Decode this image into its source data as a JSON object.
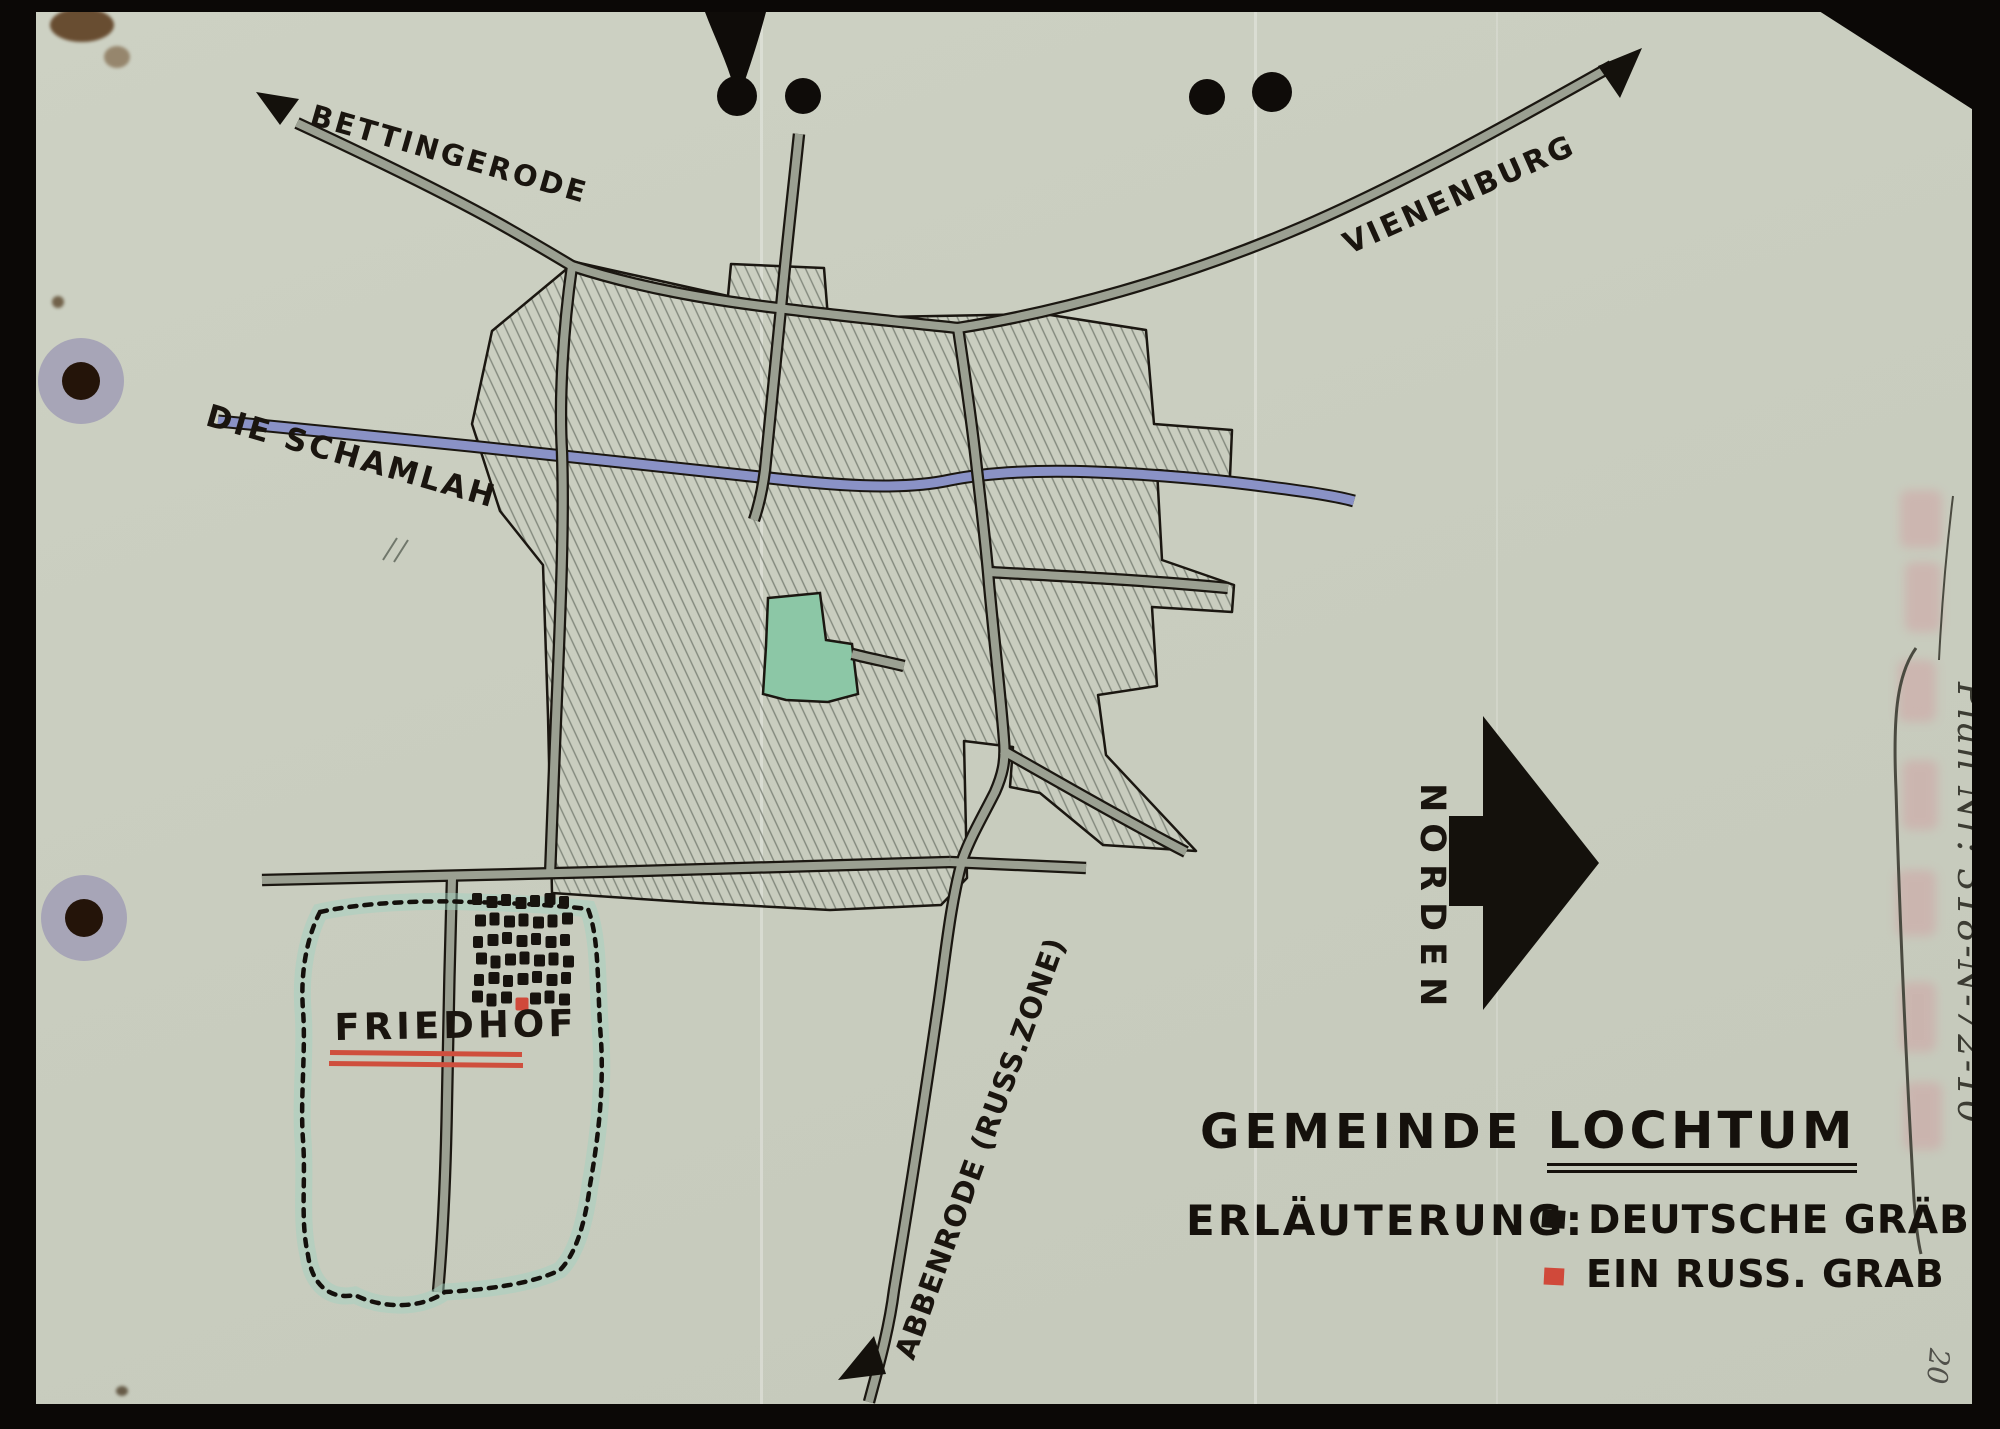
{
  "document": {
    "type": "hand-drawn cemetery location map",
    "paper_color": "#cbcfc1",
    "backdrop_color": "#0b0806"
  },
  "labels": {
    "road_bettingerode": "BETTINGERODE",
    "road_vienenburg": "VIENENBURG",
    "road_abbenrode": "ABBENRODE (RUSS.ZONE)",
    "river": "DIE SCHAMLAH",
    "cemetery": "FRIEDHOF",
    "north": "NORDEN"
  },
  "title": {
    "prefix": "GEMEINDE",
    "name": "LOCHTUM"
  },
  "legend": {
    "heading": "ERLÄUTERUNG:",
    "items": [
      {
        "label": "DEUTSCHE GRÄBER",
        "marker_color": "#17130e"
      },
      {
        "label": "EIN RUSS. GRAB",
        "marker_color": "#d0493a"
      }
    ]
  },
  "marginalia": {
    "plan_number": "Plan Nr: 318-N-72-10",
    "page_number": "20"
  },
  "map": {
    "graves": {
      "rows": 6,
      "cols": 7,
      "red_row": 5,
      "red_col": 3,
      "black_color": "#17130e",
      "red_color": "#d0493a"
    },
    "colors": {
      "road_fill": "#9ba092",
      "river_fill": "#8a92c6",
      "pond_fill": "#8cc7a6",
      "cemetery_wash": "#9fd3c0",
      "ink": "#1b1711",
      "hatch_pencil": "#70776b",
      "hole_ring": "#a7a5b7"
    }
  }
}
